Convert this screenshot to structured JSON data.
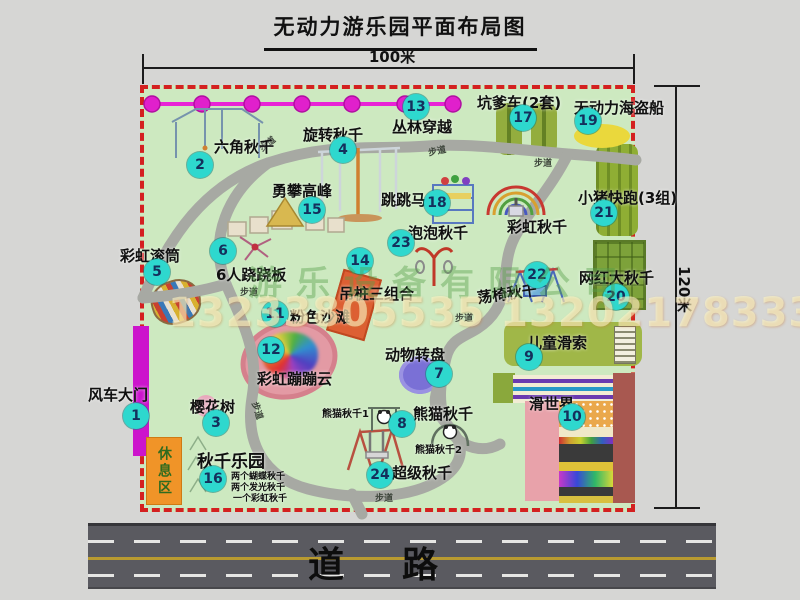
{
  "title": "无动力游乐园平面布局图",
  "dimensions": {
    "top_width": "100米",
    "right_height": "120米"
  },
  "road": {
    "label": "道路"
  },
  "rest_area_label": "休息区",
  "walkway_label": "步道",
  "rainbow_swing_label": "彩虹秋千",
  "watermark": {
    "company": "游乐设备有限公司",
    "phones": "13233805535 13202178333"
  },
  "attractions": [
    {
      "num": "1",
      "name": "风车大门"
    },
    {
      "num": "2",
      "name": "六角秋千"
    },
    {
      "num": "3",
      "name": "樱花树"
    },
    {
      "num": "4",
      "name": "旋转秋千"
    },
    {
      "num": "5",
      "name": "彩虹滚筒"
    },
    {
      "num": "6",
      "name": "6人跷跷板"
    },
    {
      "num": "7",
      "name": "动物转盘"
    },
    {
      "num": "8",
      "name": "熊猫秋千"
    },
    {
      "num": "9",
      "name": "儿童滑索"
    },
    {
      "num": "10",
      "name": "滑世界"
    },
    {
      "num": "11",
      "name": "粉色沙滩"
    },
    {
      "num": "12",
      "name": "彩虹蹦蹦云"
    },
    {
      "num": "13",
      "name": "丛林穿越"
    },
    {
      "num": "14",
      "name": "吊桩三组合"
    },
    {
      "num": "15",
      "name": "勇攀高峰"
    },
    {
      "num": "16",
      "name": "秋千乐园"
    },
    {
      "num": "17",
      "name": "坑爹车(2套)"
    },
    {
      "num": "18",
      "name": "跳跳马"
    },
    {
      "num": "19",
      "name": "无动力海盗船"
    },
    {
      "num": "20",
      "name": "网红大秋千"
    },
    {
      "num": "21",
      "name": "小猪快跑(3组)"
    },
    {
      "num": "22",
      "name": "荡椅秋千"
    },
    {
      "num": "23",
      "name": "泡泡秋千"
    },
    {
      "num": "24",
      "name": "超级秋千"
    }
  ],
  "panda_swing_subs": [
    "熊猫秋千1",
    "熊猫秋千2"
  ],
  "swing_park_items": [
    "两个蝴蝶秋千",
    "两个发光秋千",
    "一个彩虹秋千"
  ],
  "colors": {
    "badge": "#2ed8ce",
    "border": "#d42020",
    "ground": "#cde9c0",
    "zipline": "#e822d6",
    "road": "#5a5a60",
    "gate": "#cc14cc",
    "rest": "#f09428"
  }
}
